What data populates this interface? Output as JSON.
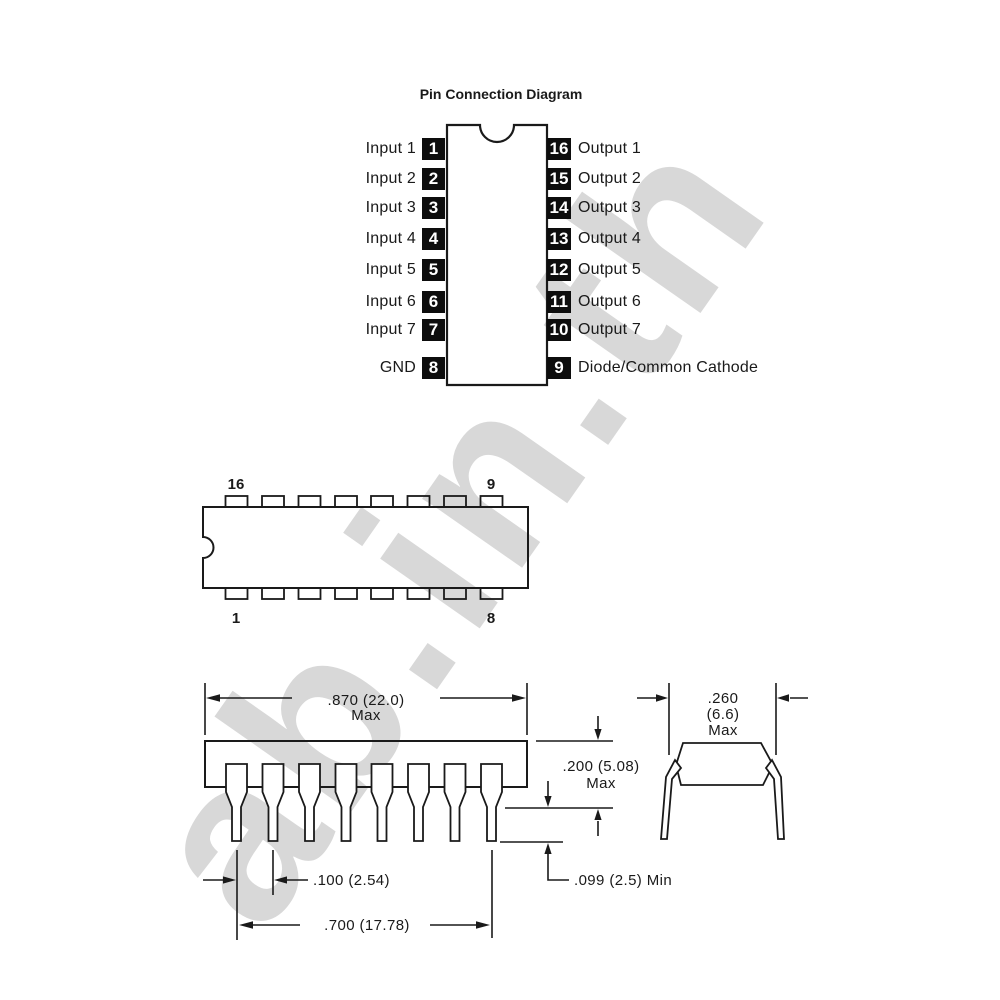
{
  "watermark": {
    "text": "ab.in.th"
  },
  "pin_diagram": {
    "title": "Pin Connection Diagram",
    "rows": [
      {
        "left_label": "Input 1",
        "left_pin": "1",
        "right_pin": "16",
        "right_label": "Output 1"
      },
      {
        "left_label": "Input 2",
        "left_pin": "2",
        "right_pin": "15",
        "right_label": "Output 2"
      },
      {
        "left_label": "Input 3",
        "left_pin": "3",
        "right_pin": "14",
        "right_label": "Output 3"
      },
      {
        "left_label": "Input 4",
        "left_pin": "4",
        "right_pin": "13",
        "right_label": "Output 4"
      },
      {
        "left_label": "Input 5",
        "left_pin": "5",
        "right_pin": "12",
        "right_label": "Output 5"
      },
      {
        "left_label": "Input 6",
        "left_pin": "6",
        "right_pin": "11",
        "right_label": "Output 6"
      },
      {
        "left_label": "Input 7",
        "left_pin": "7",
        "right_pin": "10",
        "right_label": "Output 7"
      },
      {
        "left_label": "GND",
        "left_pin": "8",
        "right_pin": "9",
        "right_label": "Diode/Common Cathode"
      }
    ]
  },
  "package_top_view": {
    "pin_top_left": "16",
    "pin_top_right": "9",
    "pin_bottom_left": "1",
    "pin_bottom_right": "8"
  },
  "mech_dimensions": {
    "body_width": {
      "value": ".870 (22.0)",
      "qualifier": "Max"
    },
    "body_height": {
      "value": ".200 (5.08)",
      "qualifier": "Max"
    },
    "body_depth": {
      "value": ".260",
      "value_mm": "(6.6)",
      "qualifier": "Max"
    },
    "lead_pitch": {
      "value": ".100 (2.54)"
    },
    "lead_tip_length": {
      "value": ".099 (2.5) Min"
    },
    "lead_row_span": {
      "value": ".700 (17.78)"
    }
  },
  "colors": {
    "ink": "#1a1a1a",
    "pin_square": "#0d0d0d",
    "watermark": "#d8d8d8"
  }
}
